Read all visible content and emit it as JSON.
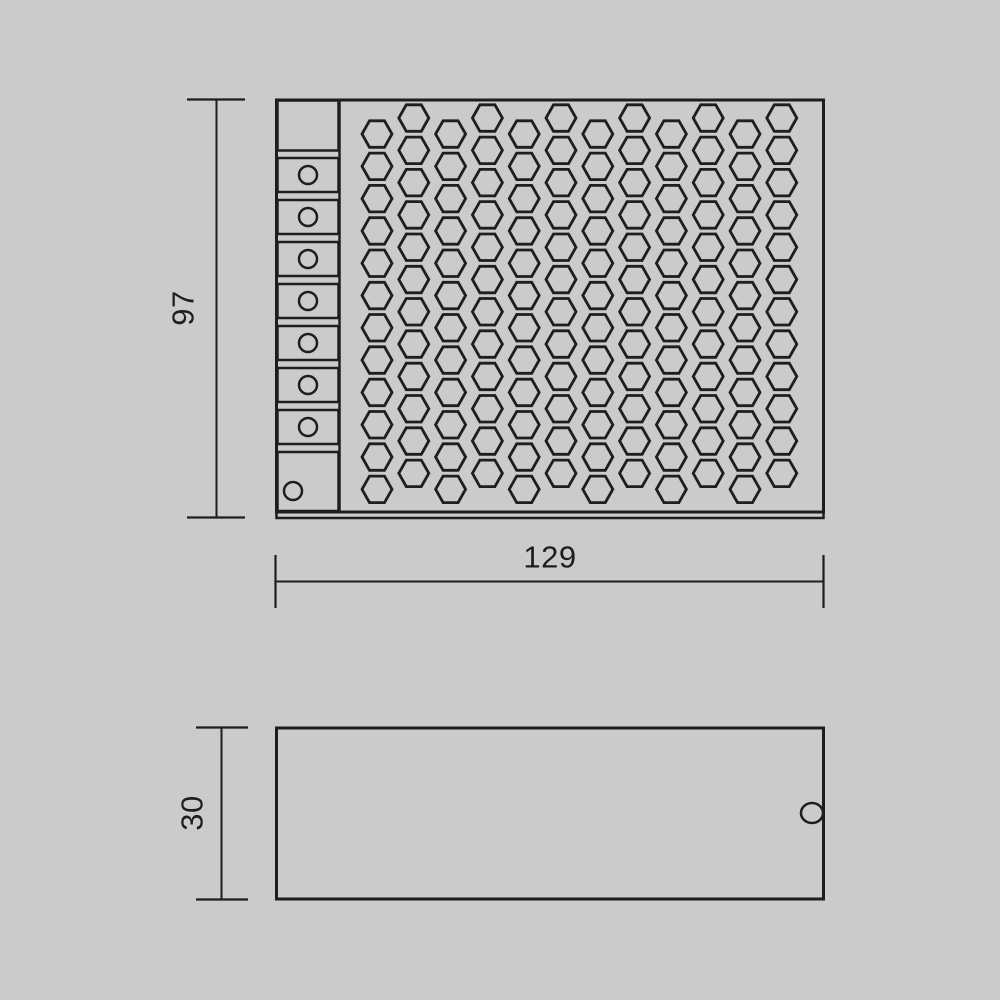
{
  "colors": {
    "background": "#cbcbcb",
    "ink": "#1e1e1e"
  },
  "dimensions": {
    "height": {
      "label": "97",
      "orientation": "vertical",
      "applies_to": "top-view"
    },
    "width": {
      "label": "129",
      "orientation": "horizontal",
      "applies_to": "top-view"
    },
    "depth": {
      "label": "30",
      "orientation": "vertical",
      "applies_to": "side-view"
    }
  },
  "top_view": {
    "terminal_block": {
      "x": 277.5,
      "w": 61,
      "segment_count": 9,
      "screw_count": 8,
      "segments": [
        {
          "y": 100.5,
          "h": 50
        },
        {
          "y": 158,
          "h": 34,
          "screw": {
            "cx": 308,
            "cy": 175,
            "r": 9
          }
        },
        {
          "y": 200,
          "h": 34,
          "screw": {
            "cx": 308,
            "cy": 217,
            "r": 9
          }
        },
        {
          "y": 242,
          "h": 34,
          "screw": {
            "cx": 308,
            "cy": 259,
            "r": 9
          }
        },
        {
          "y": 284,
          "h": 34,
          "screw": {
            "cx": 308,
            "cy": 301,
            "r": 9
          }
        },
        {
          "y": 326,
          "h": 34,
          "screw": {
            "cx": 308,
            "cy": 343,
            "r": 9
          }
        },
        {
          "y": 368,
          "h": 34,
          "screw": {
            "cx": 308,
            "cy": 385,
            "r": 9
          }
        },
        {
          "y": 410,
          "h": 34,
          "screw": {
            "cx": 308,
            "cy": 427,
            "r": 9
          }
        },
        {
          "y": 452,
          "h": 59,
          "screw": {
            "cx": 293,
            "cy": 491,
            "r": 9
          }
        }
      ]
    },
    "vent_grid": {
      "cols": 12,
      "rows": 12,
      "x0": 377,
      "col_spacing": 36.8,
      "y_first_raised": 118,
      "y_first_lowered": 134,
      "row_pitch": 32.3,
      "hex_w": 30,
      "hex_h": 26.5
    }
  },
  "side_view": {
    "notch": {
      "cx": 812,
      "cy": 813,
      "rx": 11,
      "ry": 10
    }
  }
}
